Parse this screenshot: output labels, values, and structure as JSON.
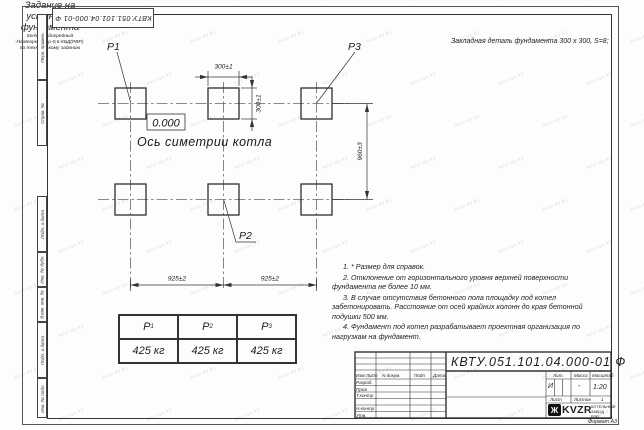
{
  "stamp_top_left": "КВТУ.051.101.04.000-01 Ф",
  "header_note": "Закладная деталь фундамента  300 x 300,  S=8;",
  "drawing": {
    "label_p1": "Р1",
    "label_p2": "Р2",
    "label_p3": "Р3",
    "elevation": "0.000",
    "axis_label": "Ось симетрии котла",
    "dim_width": "300±1",
    "dim_height": "300±1",
    "dim_rows": "960±3",
    "dim_col_left": "925±2",
    "dim_col_right": "925±2"
  },
  "notes": [
    "1. * Размер для справок.",
    "2. Отклонение от горизонтального уровня верхней поверхности фундамента не более 10 мм.",
    "3. В случае отсутствия бетонного пола площадку под котел забетонировать. Расстояние от осей крайних колонн до края бетонной подушки 500 мм.",
    "4. Фундамент под котел разрабатывает проектная организация по нагрузкам на фундамент."
  ],
  "load_table": {
    "headers": [
      {
        "base": "Р",
        "sub": "1"
      },
      {
        "base": "Р",
        "sub": "2"
      },
      {
        "base": "Р",
        "sub": "3"
      }
    ],
    "values": [
      "425 кг",
      "425 кг",
      "425 кг"
    ]
  },
  "title_block": {
    "doc_number": "КВТУ.051.101.04.000-01  Ф",
    "title_line1": "Задание на",
    "title_line2": "установку",
    "title_line3": "фундамента",
    "product_line1": "Котел водогрейный",
    "product_line2": "Heatexpert-КВр-0,6-КБД(РВР)",
    "product_line3": "по техническому заданию",
    "col_izm": "Изм.Лист",
    "col_ndok": "N докум.",
    "col_podp": "Подп",
    "col_data": "Дата",
    "rows": [
      "Разраб.",
      "Пров",
      "Т.контр",
      "",
      "Н.контр",
      "Утв."
    ],
    "lit_label": "Лит.",
    "massa_label": "Масса",
    "masshtab_label": "Масштаб",
    "lit_value": "И",
    "massa_value": "-",
    "masshtab_value": "1:20",
    "list_label": "Лист",
    "listov_label": "Листов",
    "listov_value": "1",
    "logo_text": "KVZR",
    "logo_sub": "КОТЕЛЬНЫЙ ЗАВОД РЭП",
    "format_label": "Формат А3"
  },
  "side_strip": {
    "labels": [
      "Перв. примен.",
      "Справ. №",
      "Подп. и дата",
      "Инв. № дубл.",
      "Взам. инв. №",
      "Подп. и дата",
      "Инв. № подл."
    ]
  },
  "watermark": {
    "text": "kvzr.kv.kz"
  }
}
